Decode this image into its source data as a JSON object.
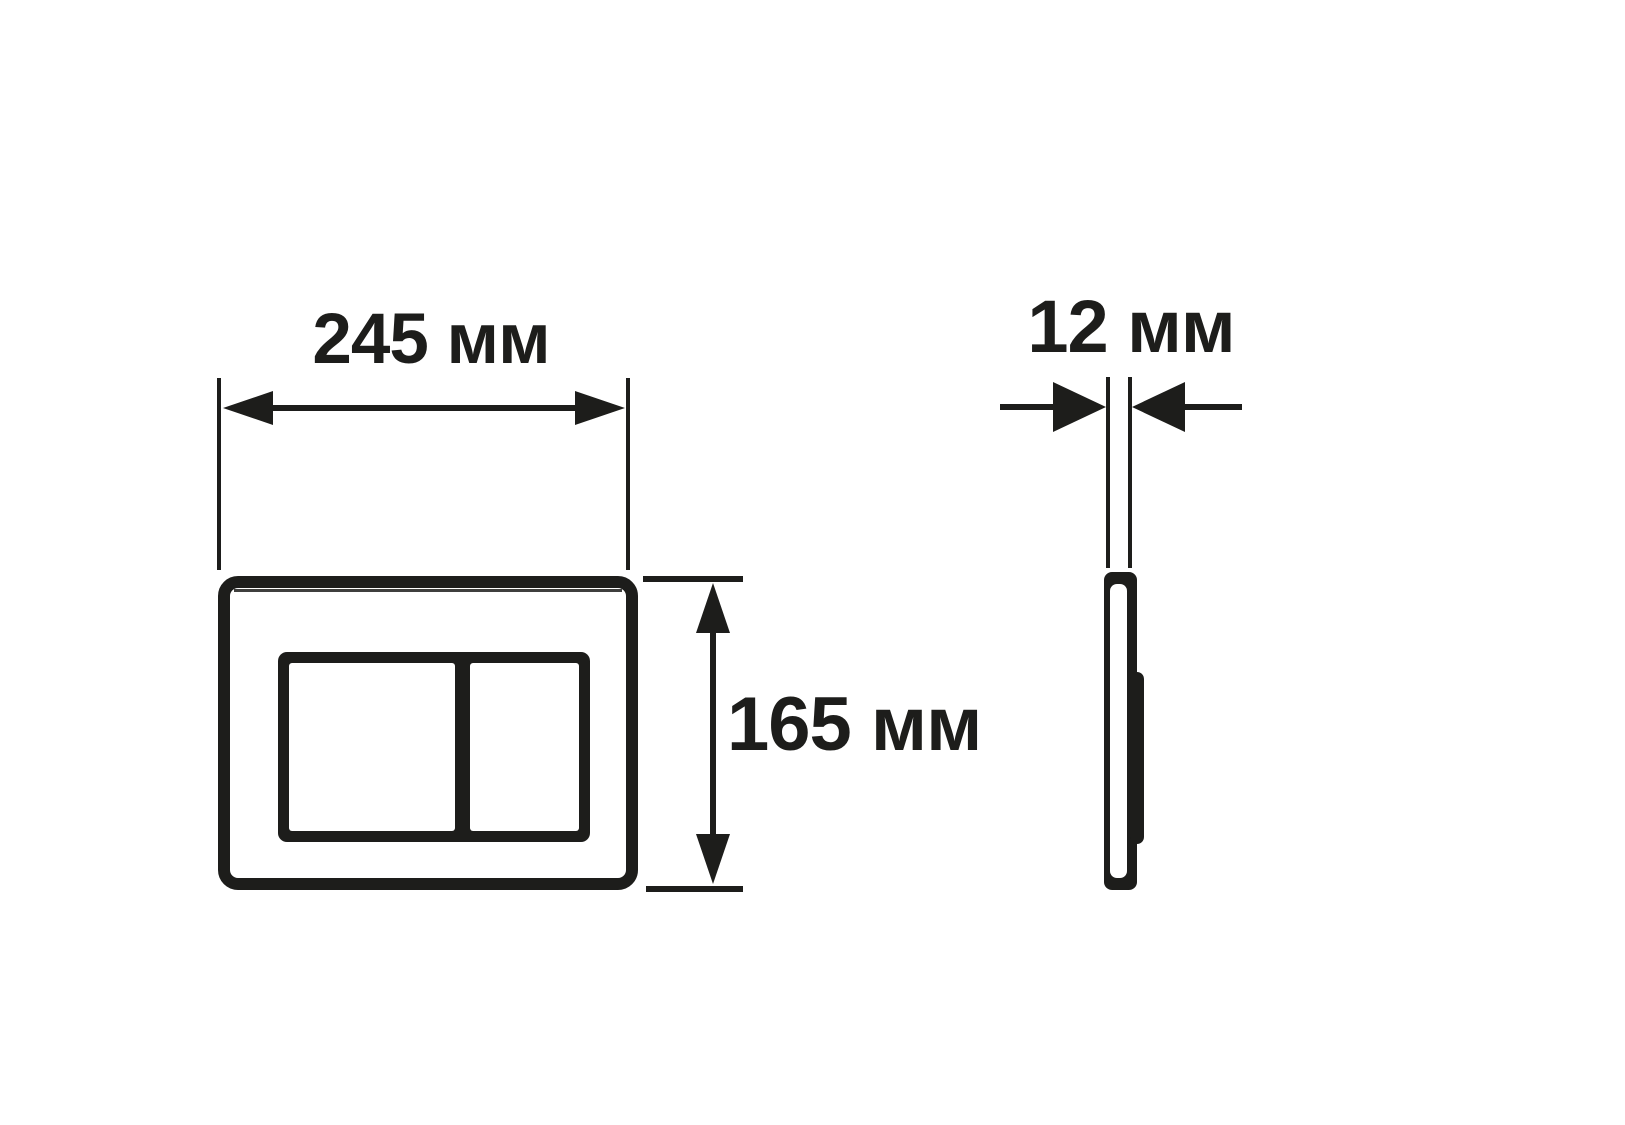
{
  "drawing": {
    "dimensions": {
      "width": {
        "label": "245 мм",
        "value": 245,
        "unit": "мм"
      },
      "height": {
        "label": "165 мм",
        "value": 165,
        "unit": "мм"
      },
      "thickness": {
        "label": "12 мм",
        "value": 12,
        "unit": "мм"
      }
    },
    "colors": {
      "ink": "#1d1d1b",
      "background": "#ffffff"
    }
  }
}
